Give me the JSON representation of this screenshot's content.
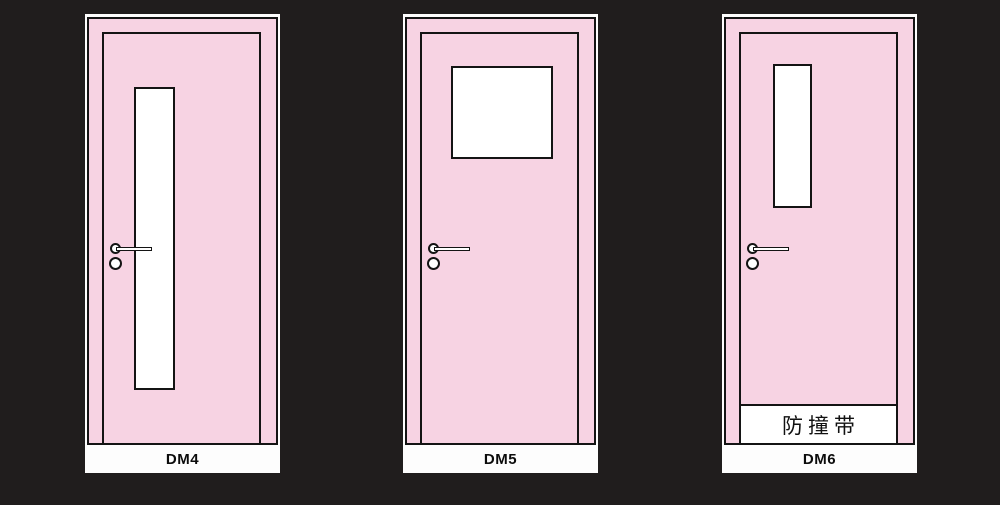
{
  "page": {
    "background_color": "#201d1d"
  },
  "palette": {
    "door_fill": "#f7d3e3",
    "outline": "#141414",
    "frame_white": "#fdfdfd",
    "glass_white": "#ffffff"
  },
  "doors": [
    {
      "label": "DM4",
      "window": "tall narrow vertical glass pane, left of center"
    },
    {
      "label": "DM5",
      "window": "wide rectangular glass pane at top, centered"
    },
    {
      "label": "DM6",
      "window": "narrow vertical glass pane at top, left of center",
      "strip_label": "防撞带"
    }
  ]
}
